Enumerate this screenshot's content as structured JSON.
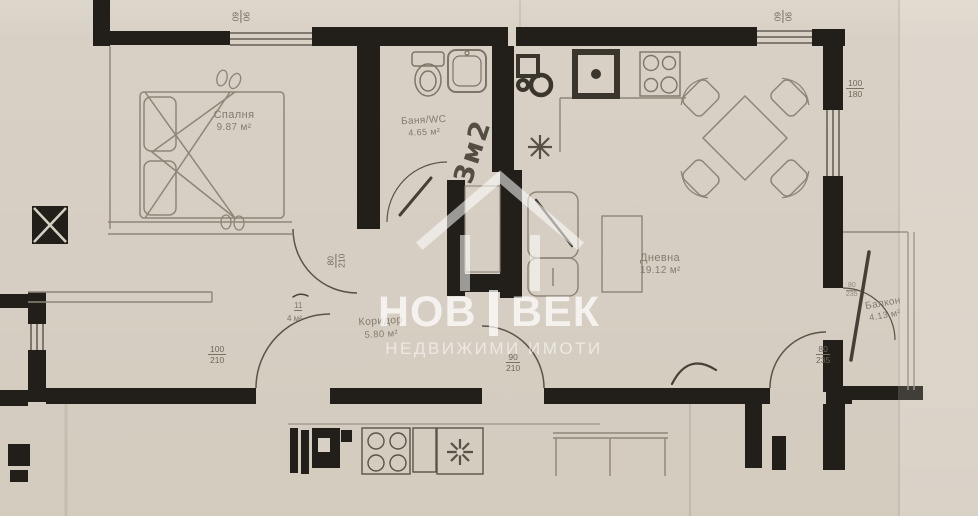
{
  "watermark": {
    "left": "НОВ",
    "right": "ВЕК",
    "subtitle": "НЕДВИЖИМИ ИМОТИ"
  },
  "rooms": {
    "bedroom": {
      "name": "Спалня",
      "area": "9.87 м²"
    },
    "bathroom": {
      "name": "Баня/WC",
      "area": "4.65 м²"
    },
    "living": {
      "name": "Дневна",
      "area": "19.12 м²"
    },
    "corridor": {
      "name": "Коридор",
      "area": "5.80 м²"
    },
    "balcony": {
      "name": "Балкон",
      "area": "4.13 м²"
    }
  },
  "annotations": {
    "handwritten_area": "3м2",
    "closet_width": "11",
    "closet_area": "4 м²"
  },
  "dimensions": {
    "window_top_left": {
      "n": "90",
      "d": "60"
    },
    "window_top_right": {
      "n": "90",
      "d": "60"
    },
    "window_right": {
      "n": "100",
      "d": "180"
    },
    "bedroom_door": {
      "n": "80",
      "d": "210"
    },
    "entrance_door": {
      "n": "100",
      "d": "210"
    },
    "corridor_door": {
      "n": "90",
      "d": "210"
    },
    "terrace_door": {
      "n": "80",
      "d": "235"
    },
    "balcony_door": {
      "n": "80",
      "d": "235"
    }
  },
  "colors": {
    "paper": "#d8d0c4",
    "wall": "#221f1a",
    "ink": "#8d8577",
    "pencil": "#453f37",
    "watermark": "#ffffff"
  }
}
